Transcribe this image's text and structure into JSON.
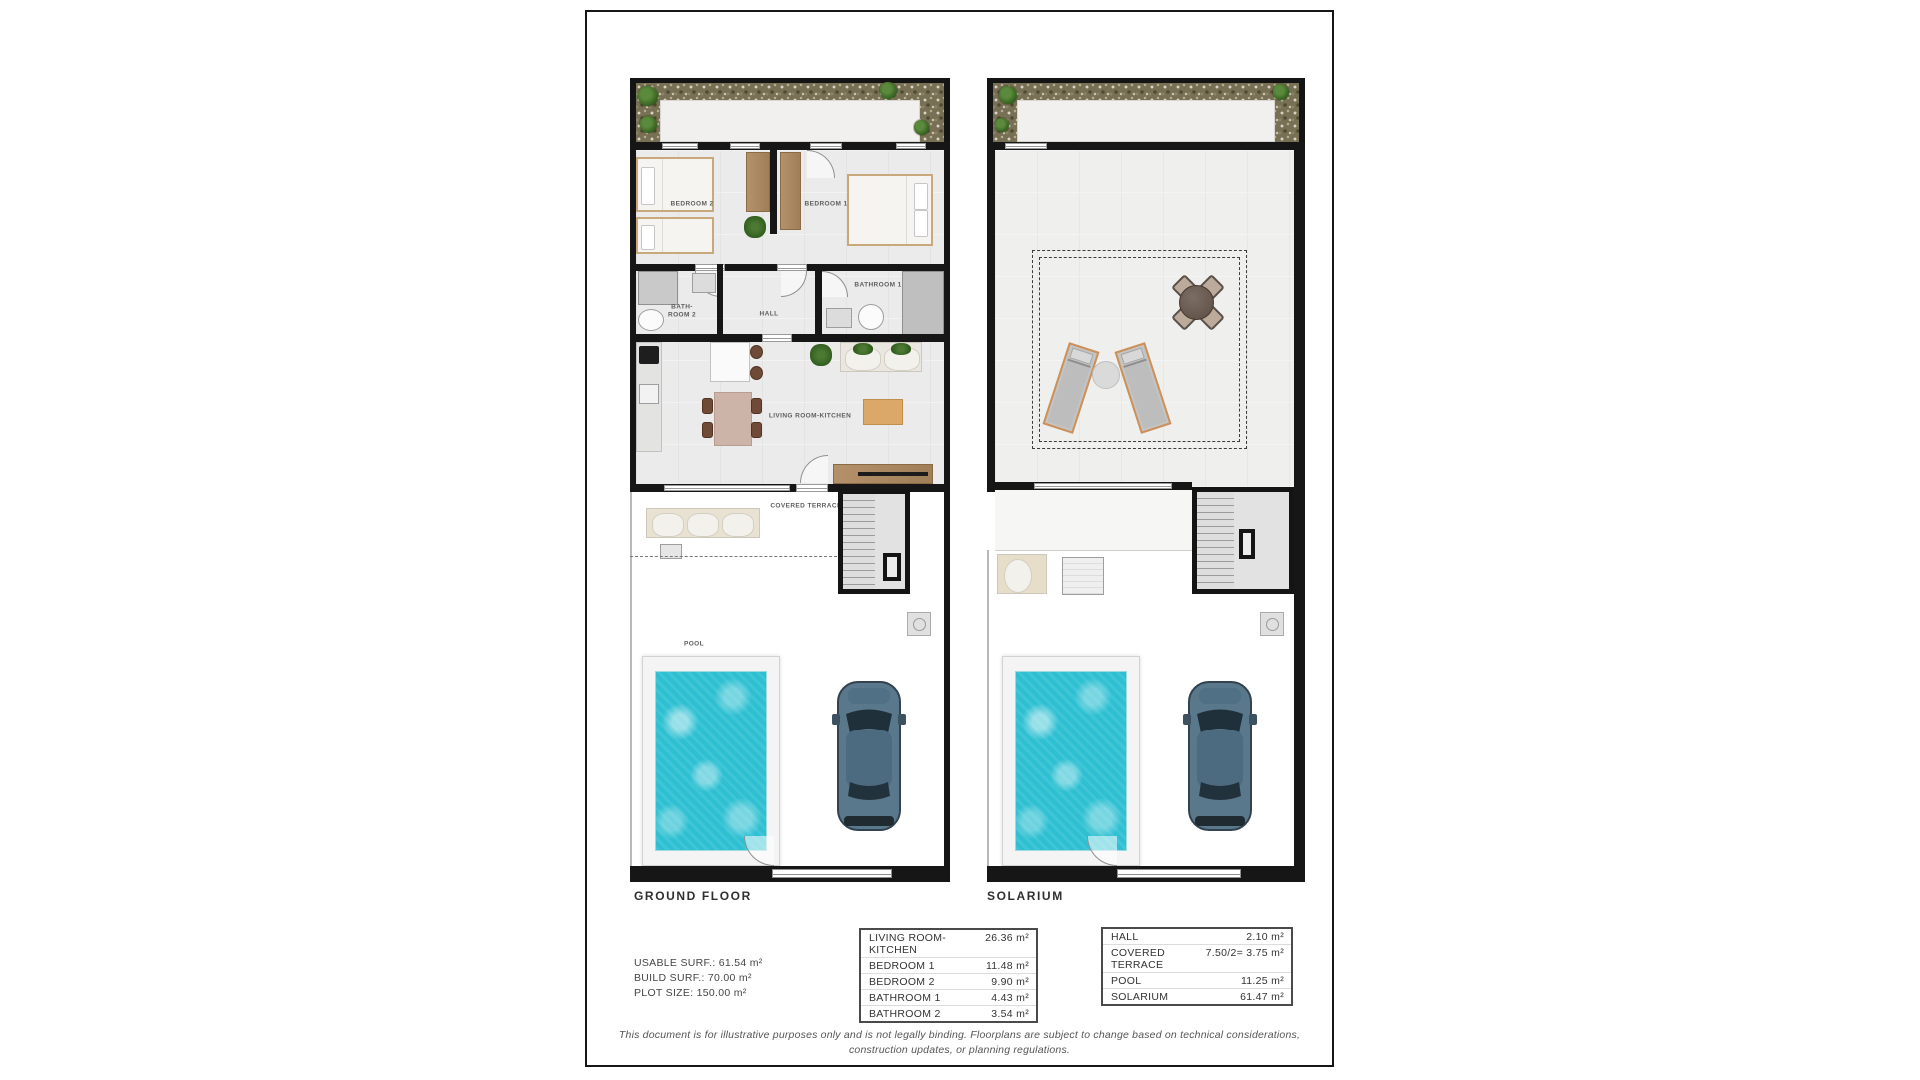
{
  "page": {
    "titles": {
      "ground": "GROUND FLOOR",
      "solarium": "SOLARIUM"
    }
  },
  "ground_plan": {
    "labels": {
      "bedroom2": "BEDROOM 2",
      "bedroom1": "BEDROOM 1",
      "bathroom2_line1": "BATH-",
      "bathroom2_line2": "ROOM 2",
      "hall": "HALL",
      "bathroom1": "BATHROOM 1",
      "living": "LIVING ROOM-KITCHEN",
      "covered_terrace": "COVERED TERRACE",
      "pool": "POOL"
    }
  },
  "surface_summary": {
    "usable": "USABLE SURF.: 61.54 m²",
    "build": "BUILD SURF.: 70.00 m²",
    "plot": "PLOT SIZE: 150.00 m²"
  },
  "area_tables": {
    "ground": {
      "rows": [
        {
          "name": "LIVING ROOM-KITCHEN",
          "area": "26.36 m²"
        },
        {
          "name": "BEDROOM 1",
          "area": "11.48 m²"
        },
        {
          "name": "BEDROOM 2",
          "area": "9.90 m²"
        },
        {
          "name": "BATHROOM 1",
          "area": "4.43 m²"
        },
        {
          "name": "BATHROOM 2",
          "area": "3.54 m²"
        }
      ]
    },
    "other": {
      "rows": [
        {
          "name": "HALL",
          "area": "2.10 m²"
        },
        {
          "name": "COVERED TERRACE",
          "area": "7.50/2= 3.75 m²"
        },
        {
          "name": "POOL",
          "area": "11.25 m²"
        },
        {
          "name": "SOLARIUM",
          "area": "61.47 m²"
        }
      ]
    }
  },
  "disclaimer": {
    "line1": "This document is for illustrative purposes only and is not legally binding. Floorplans are subject to change based on technical considerations,",
    "line2": "construction updates, or planning regulations."
  },
  "colors": {
    "wall": "#161616",
    "pool_water": "#2ec0d2",
    "wood": "#ae8a63",
    "car_body": "#5a788c",
    "plan_floor": "#ebebeb",
    "garden_gravel": "#787054"
  }
}
